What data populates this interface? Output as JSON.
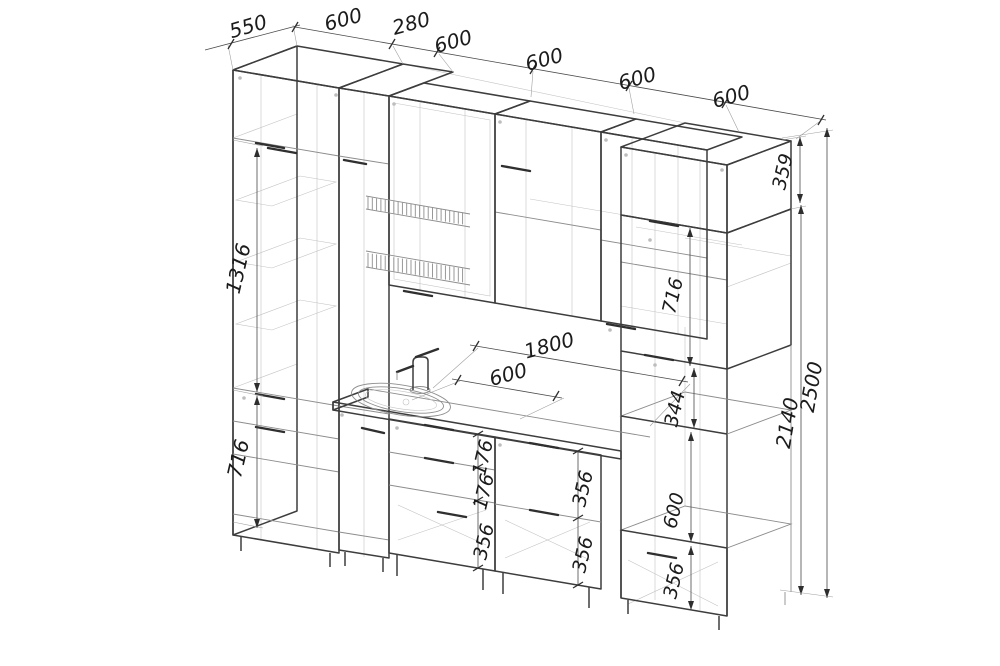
{
  "drawing": {
    "kind": "kitchen cabinet set - dimensioned isometric line drawing",
    "dims": {
      "top": [
        "550",
        "600",
        "280",
        "600",
        "600",
        "600",
        "600"
      ],
      "left": {
        "upper": "1316",
        "base": "716"
      },
      "counter": {
        "run": "1800",
        "cabinet": "600"
      },
      "right": {
        "box": "359",
        "upper": "716",
        "gap": "344",
        "oven": "600",
        "drawer": "356"
      },
      "overall": {
        "body": "2140",
        "total": "2500"
      },
      "sink_stack": [
        "176",
        "176",
        "356"
      ],
      "drawer_stack": [
        "356",
        "356"
      ]
    }
  }
}
